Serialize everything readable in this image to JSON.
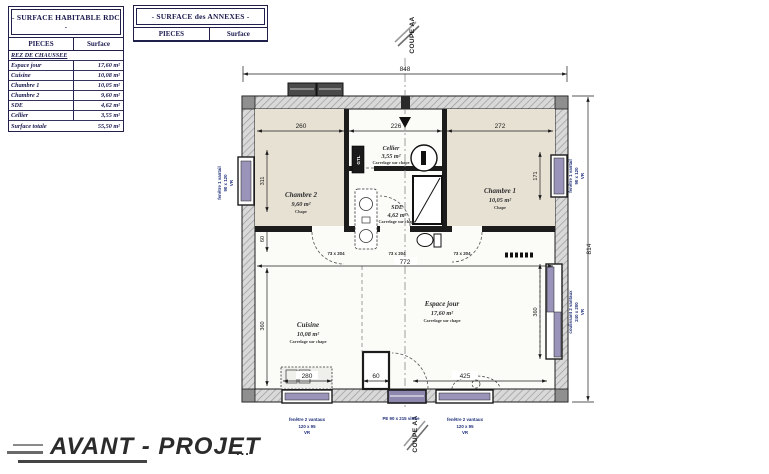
{
  "tables": {
    "habitable": {
      "title": "- SURFACE HABITABLE RDC -",
      "headers": {
        "pieces": "PIECES",
        "surface": "Surface"
      },
      "section": "REZ DE CHAUSSEE",
      "rows": [
        {
          "label": "Espace jour",
          "value": "17,60 m²"
        },
        {
          "label": "Cuisine",
          "value": "10,08 m²"
        },
        {
          "label": "Chambre 1",
          "value": "10,05 m²"
        },
        {
          "label": "Chambre 2",
          "value": "9,60 m²"
        },
        {
          "label": "SDE",
          "value": "4,62 m²"
        },
        {
          "label": "Cellier",
          "value": "3,55 m²"
        }
      ],
      "total": {
        "label": "Surface totale",
        "value": "55,50 m²"
      }
    },
    "annexes": {
      "title": "- SURFACE des ANNEXES -",
      "headers": {
        "pieces": "PIECES",
        "surface": "Surface"
      }
    }
  },
  "plan": {
    "rooms": {
      "chambre2": {
        "name": "Chambre 2",
        "area": "9,60 m²",
        "floor": "Chape"
      },
      "cellier": {
        "name": "Cellier",
        "area": "3,55 m²",
        "floor": "Carrelage sur chape"
      },
      "sde": {
        "name": "SDE",
        "area": "4,62 m²",
        "floor": "Carrelage sur chape"
      },
      "chambre1": {
        "name": "Chambre 1",
        "area": "10,05 m²",
        "floor": "Chape"
      },
      "cuisine": {
        "name": "Cuisine",
        "area": "10,08 m²",
        "floor": "Carrelage sur chape"
      },
      "espace_jour": {
        "name": "Espace jour",
        "area": "17,60 m²",
        "floor": "Carrelage sur chape"
      }
    },
    "dims": {
      "total_width": "848",
      "total_height": "814",
      "chambre2_width": "260",
      "middle_width": "226",
      "chambre1_width": "272",
      "interior_width": "772",
      "window_left_height": "311",
      "left_offset": "60",
      "cuisine_depth": "360",
      "window_right_height": "171",
      "bay_height": "360",
      "espace_jour_width": "425",
      "kitchen_counter": "280",
      "stub_width": "60"
    },
    "door_label": "73 x 204",
    "openings": {
      "window_left": {
        "l1": "fenêtre 1 vantail",
        "l2": "90 x 120",
        "l3": "VR"
      },
      "window_right": {
        "l1": "fenêtre 1 vantail",
        "l2": "90 x 120",
        "l3": "VR"
      },
      "bay": {
        "l1": "coulissant 2 vantaux",
        "l2": "240 x 200",
        "l3": "VR"
      },
      "window_bottom_left": {
        "l1": "fenêtre 2 vantaux",
        "l2": "120 x 95",
        "l3": "VR"
      },
      "window_bottom_right": {
        "l1": "fenêtre 2 vantaux",
        "l2": "120 x 95",
        "l3": "VR"
      },
      "entry": "PE 90 x 215 vitrée"
    },
    "section_label": "COUPE AA",
    "gtl": "GTL"
  },
  "footer": {
    "title": "AVANT - PROJET",
    "dots": "..."
  },
  "colors": {
    "window": "#9b94ba",
    "room_beige": "#e7e1d4",
    "accent_navy": "#1f2f7a"
  }
}
